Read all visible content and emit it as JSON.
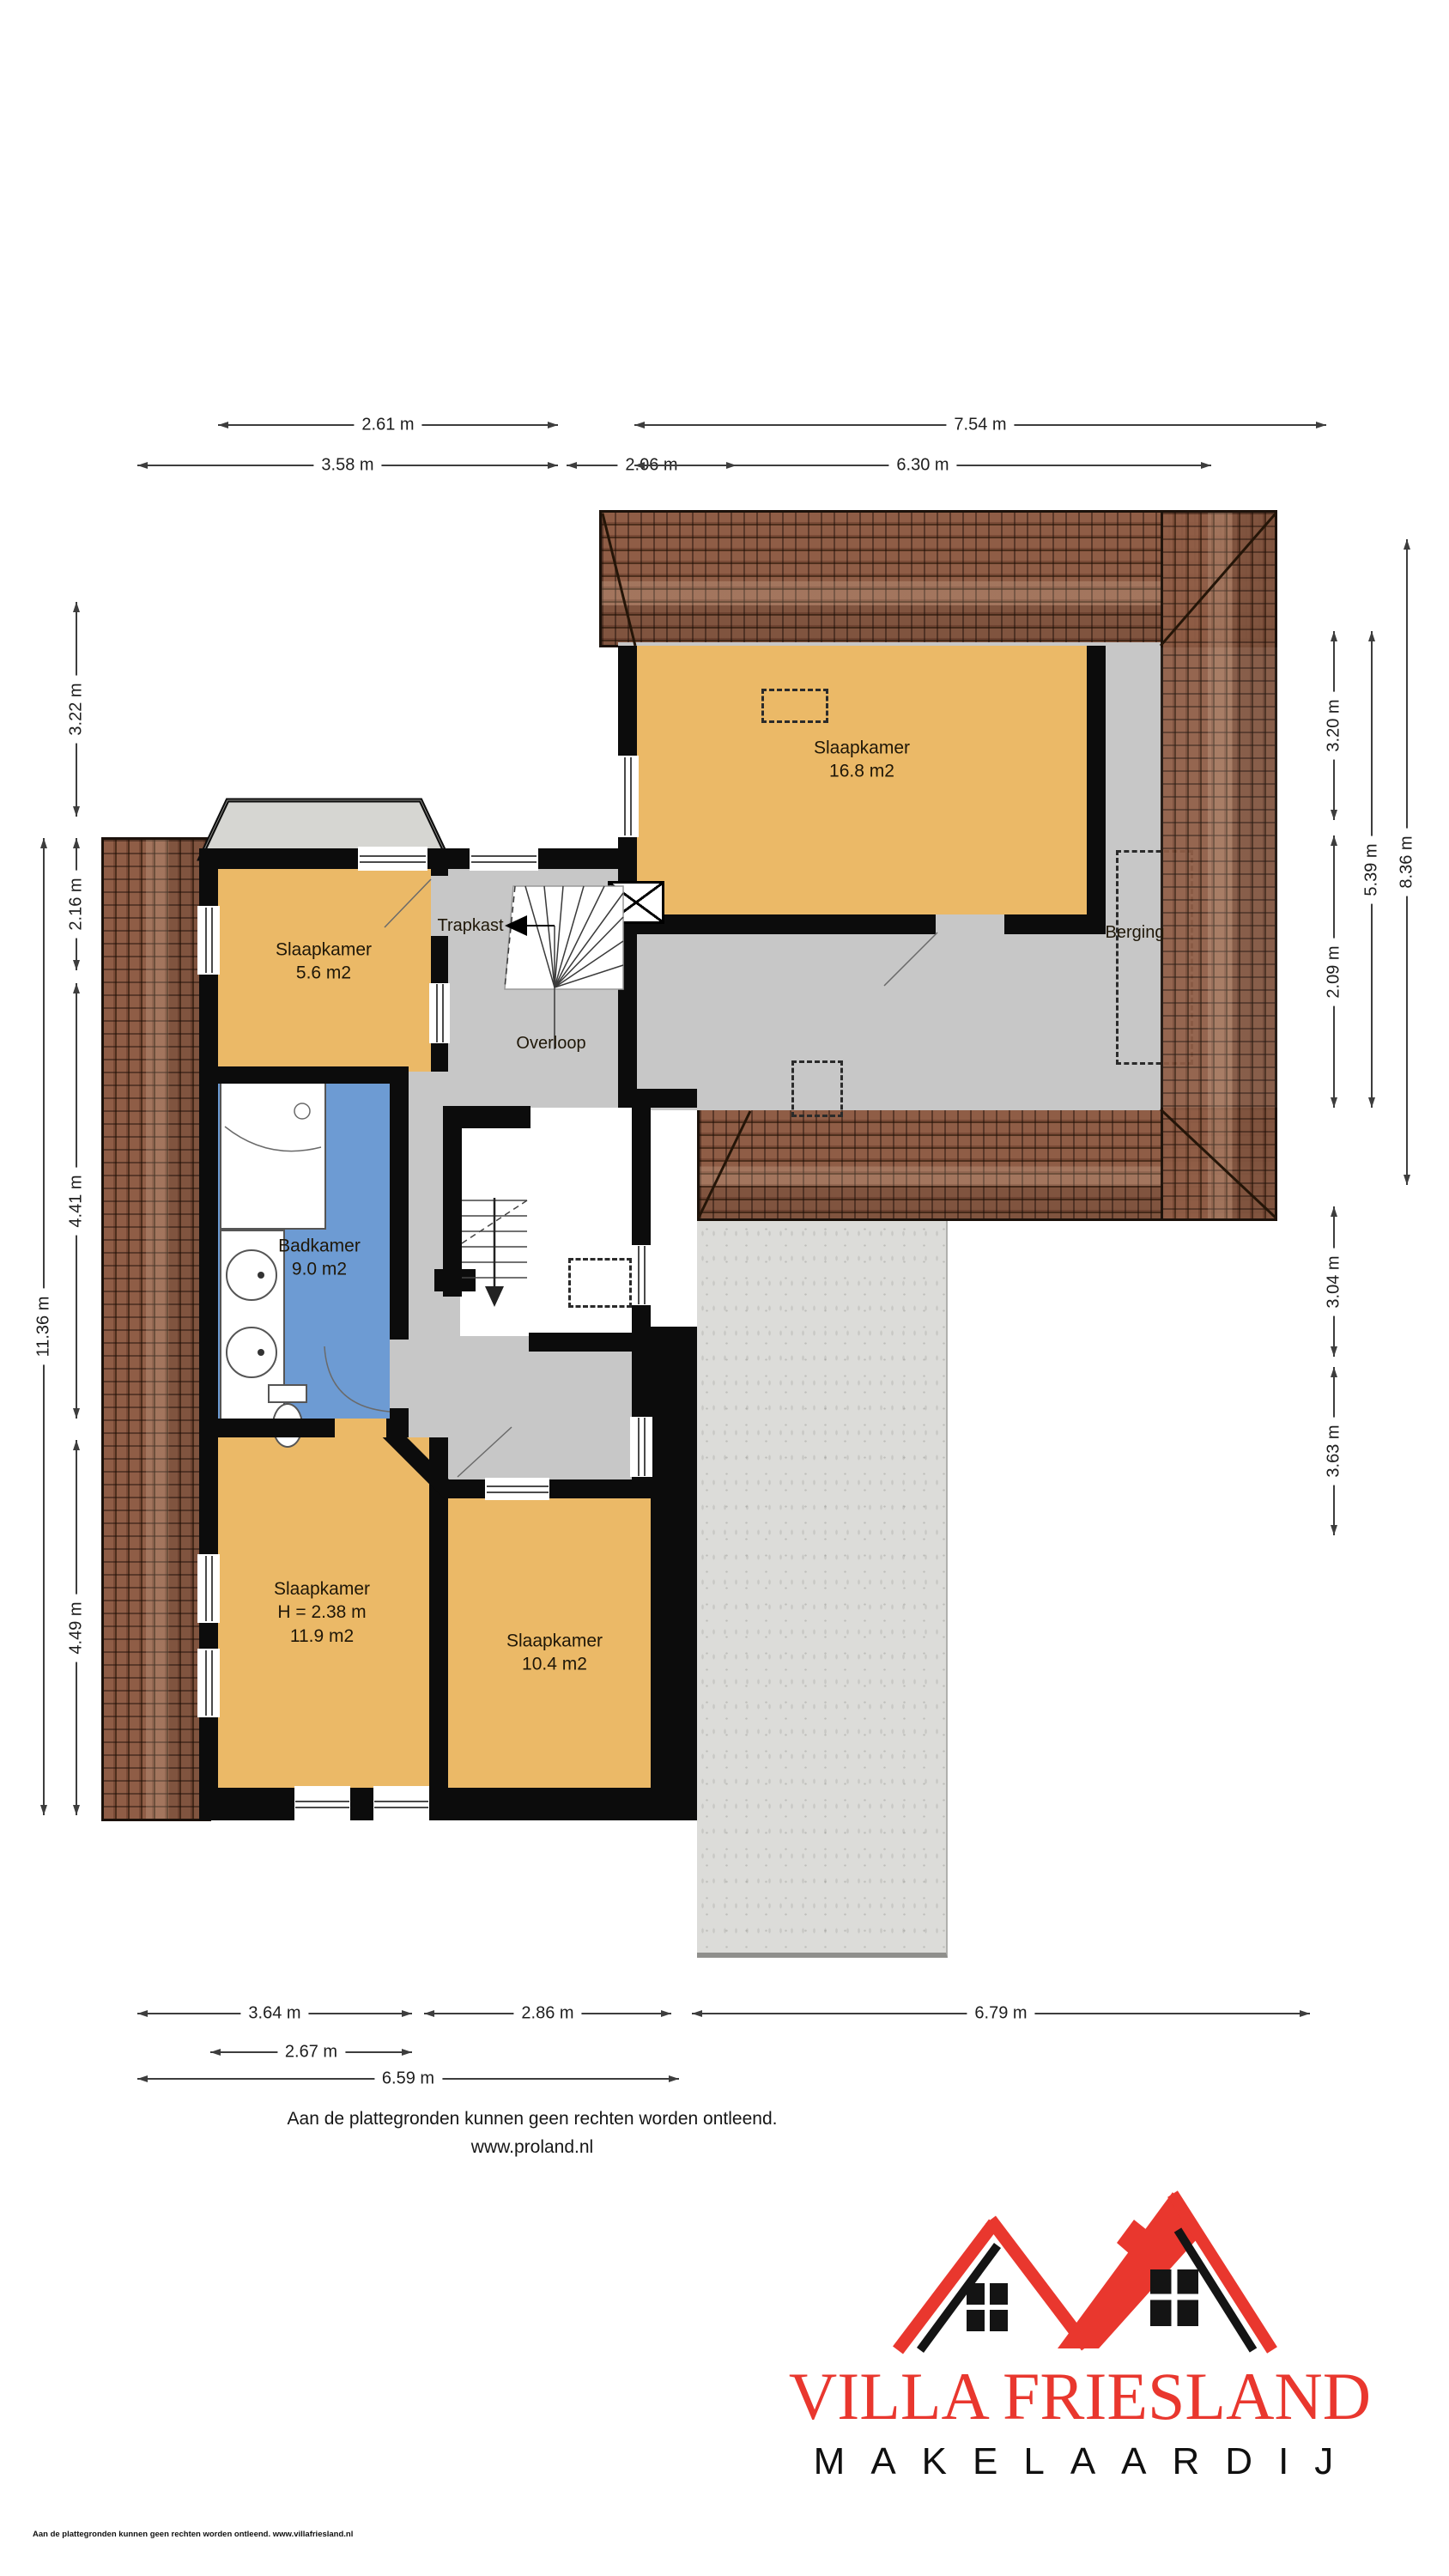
{
  "plan_title": "Eerste verdieping plattegrond",
  "rooms": {
    "slaapkamer_groot": {
      "name": "Slaapkamer",
      "area": "16.8 m2"
    },
    "slaapkamer_klein": {
      "name": "Slaapkamer",
      "area": "5.6 m2"
    },
    "trapkast": {
      "name": "Trapkast"
    },
    "berging": {
      "name": "Berging"
    },
    "overloop": {
      "name": "Overloop"
    },
    "badkamer": {
      "name": "Badkamer",
      "area": "9.0 m2"
    },
    "slaapkamer_links": {
      "name": "Slaapkamer",
      "height": "H = 2.38 m",
      "area": "11.9 m2"
    },
    "slaapkamer_midden": {
      "name": "Slaapkamer",
      "area": "10.4 m2"
    }
  },
  "dimensions": {
    "top": [
      {
        "label": "2.61 m"
      },
      {
        "label": "7.54 m"
      },
      {
        "label": "3.58 m"
      },
      {
        "label": "2.06 m"
      },
      {
        "label": "6.30 m"
      }
    ],
    "left": [
      {
        "label": "3.22 m"
      },
      {
        "label": "2.16 m"
      },
      {
        "label": "11.36 m"
      },
      {
        "label": "4.41 m"
      },
      {
        "label": "4.49 m"
      }
    ],
    "right": [
      {
        "label": "3.20 m"
      },
      {
        "label": "2.09 m"
      },
      {
        "label": "5.39 m"
      },
      {
        "label": "8.36 m"
      },
      {
        "label": "3.04 m"
      },
      {
        "label": "3.63 m"
      }
    ],
    "bottom": [
      {
        "label": "3.64 m"
      },
      {
        "label": "2.86 m"
      },
      {
        "label": "6.79 m"
      },
      {
        "label": "2.67 m"
      },
      {
        "label": "6.59 m"
      }
    ]
  },
  "footer": {
    "disclaimer": "Aan de plattegronden kunnen geen rechten worden ontleend.",
    "website": "www.proland.nl",
    "fine_print": "Aan de plattegronden kunnen geen rechten worden ontleend. www.villafriesland.nl"
  },
  "logo": {
    "title": "VILLA FRIESLAND",
    "subtitle": "MAKELAARDIJ"
  },
  "colors": {
    "room_fill": "#ebb967",
    "bathroom_fill": "#6d9bd3",
    "floor_fill": "#c7c7c7",
    "roof_tile": "#8f5d46",
    "concrete": "#dcdcd9",
    "wall": "#0c0c0c",
    "logo_red": "#e9372e",
    "logo_black": "#101010"
  }
}
